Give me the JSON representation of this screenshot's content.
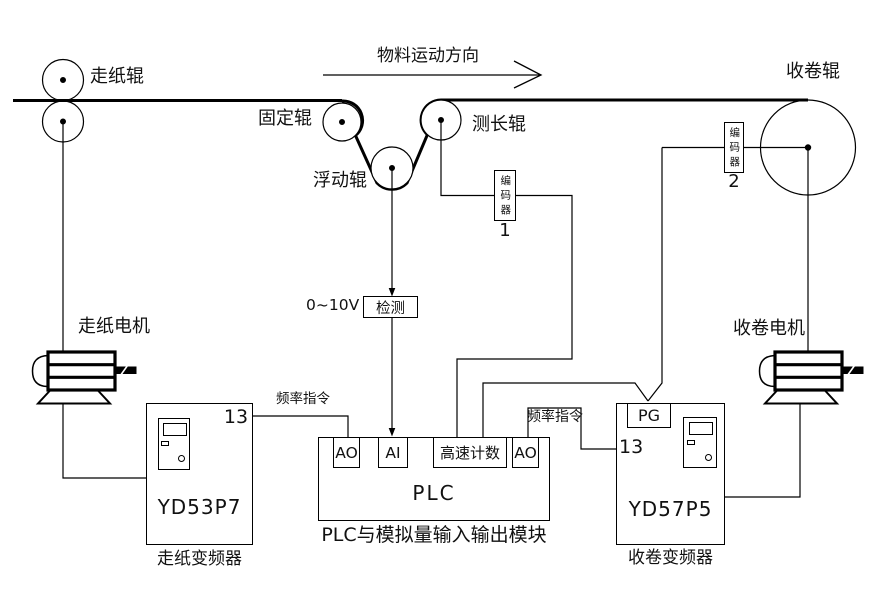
{
  "colors": {
    "background": "#ffffff",
    "line": "#000000",
    "text": "#111111"
  },
  "web": {
    "direction": "物料运动方向"
  },
  "rollers": {
    "feed": "走纸辊",
    "fixed": "固定辊",
    "floating": "浮动辊",
    "measuring": "测长辊",
    "winding": "收卷辊"
  },
  "encoder1": {
    "name": "编码器",
    "no": "1"
  },
  "encoder2": {
    "name": "编码器",
    "no": "2"
  },
  "detection": {
    "range": "0~10V",
    "label": "检测"
  },
  "motors": {
    "feed": "走纸电机",
    "winding": "收卷电机"
  },
  "plc": {
    "name": "PLC",
    "caption": "PLC与模拟量输入输出模块",
    "modules": [
      "AO",
      "AI",
      "高速计数",
      "AO"
    ]
  },
  "feed_inverter": {
    "model": "YD53P7",
    "caption": "走纸变频器",
    "terminal": "13",
    "signal": "频率指令"
  },
  "winding_inverter": {
    "model": "YD57P5",
    "caption": "收卷变频器",
    "terminal": "13",
    "signal": "频率指令",
    "pg": "PG"
  }
}
